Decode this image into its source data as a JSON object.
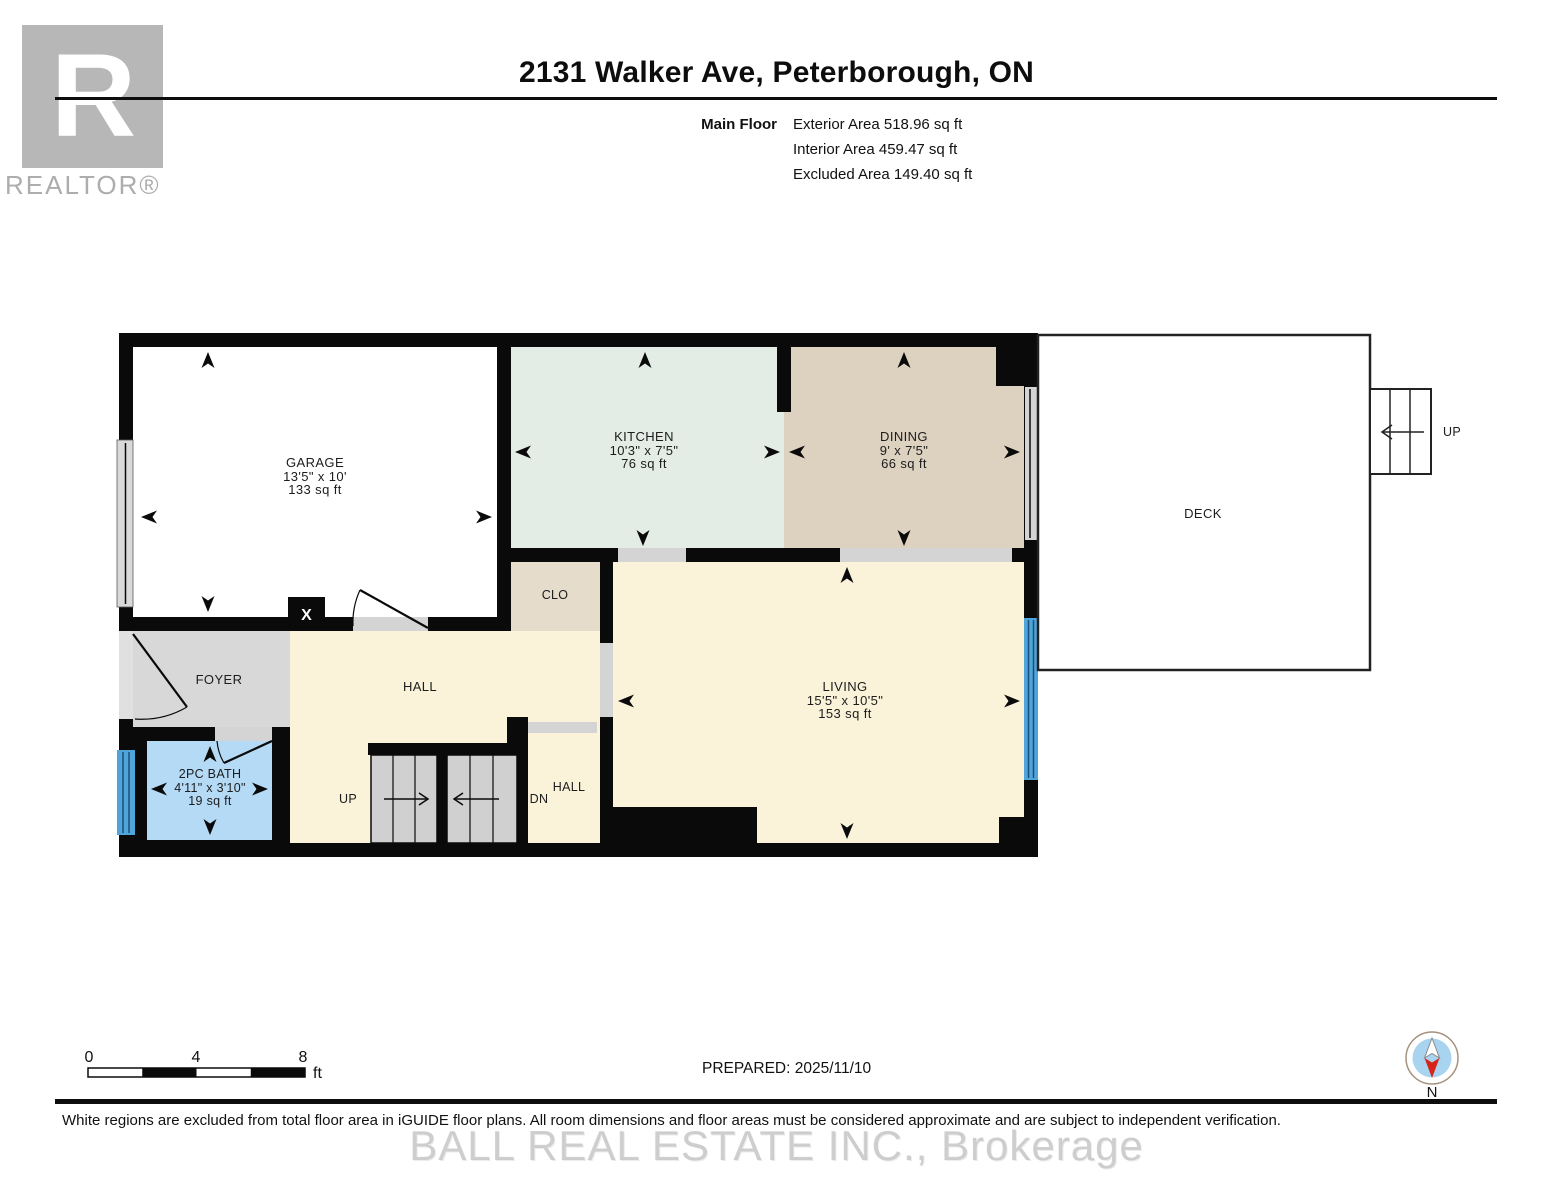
{
  "header": {
    "title": "2131 Walker Ave, Peterborough, ON",
    "floor_label": "Main Floor",
    "stats": {
      "exterior": "Exterior Area 518.96 sq ft",
      "interior": "Interior Area 459.47 sq ft",
      "excluded": "Excluded Area 149.40 sq ft"
    }
  },
  "logo": {
    "letter": "R",
    "brand": "REALTOR®"
  },
  "rooms": {
    "garage": {
      "name": "GARAGE",
      "dims": "13'5\" x 10'",
      "area": "133 sq ft"
    },
    "kitchen": {
      "name": "KITCHEN",
      "dims": "10'3\" x 7'5\"",
      "area": "76 sq ft"
    },
    "dining": {
      "name": "DINING",
      "dims": "9' x 7'5\"",
      "area": "66 sq ft"
    },
    "living": {
      "name": "LIVING",
      "dims": "15'5\" x 10'5\"",
      "area": "153 sq ft"
    },
    "bath": {
      "name": "2PC BATH",
      "dims": "4'11\" x 3'10\"",
      "area": "19 sq ft"
    },
    "closet": {
      "name": "CLO"
    },
    "foyer": {
      "name": "FOYER"
    },
    "hall": {
      "name": "HALL"
    },
    "hall_lower": {
      "name": "HALL"
    },
    "deck": {
      "name": "DECK"
    }
  },
  "stairs": {
    "up_label": "UP",
    "down_label": "DN",
    "deck_up_label": "UP"
  },
  "markers": {
    "post": "X",
    "compass_north": "N"
  },
  "scale_bar": {
    "tick_0": "0",
    "tick_4": "4",
    "tick_8": "8",
    "unit": "ft"
  },
  "footer": {
    "prepared": "PREPARED: 2025/11/10",
    "disclaimer": "White regions are excluded from total floor area in iGUIDE floor plans. All room dimensions and floor areas must be considered approximate and are subject to independent verification.",
    "watermark": "BALL REAL ESTATE INC., Brokerage"
  },
  "colors": {
    "wall": "#0a0a0a",
    "kitchen_fill": "#e3ede6",
    "dining_fill": "#ddd1c0",
    "closet_fill": "#e6dccb",
    "living_fill": "#faf3da",
    "foyer_fill": "#d8d8d8",
    "bath_fill": "#b5daf5",
    "stair_fill": "#d0d0d0",
    "opening_fill": "#d4d4d4",
    "window_blue": "#4fa5da",
    "compass_blue": "#a9d4ef",
    "compass_red": "#d62518",
    "logo_gray": "#b7b7b7"
  }
}
